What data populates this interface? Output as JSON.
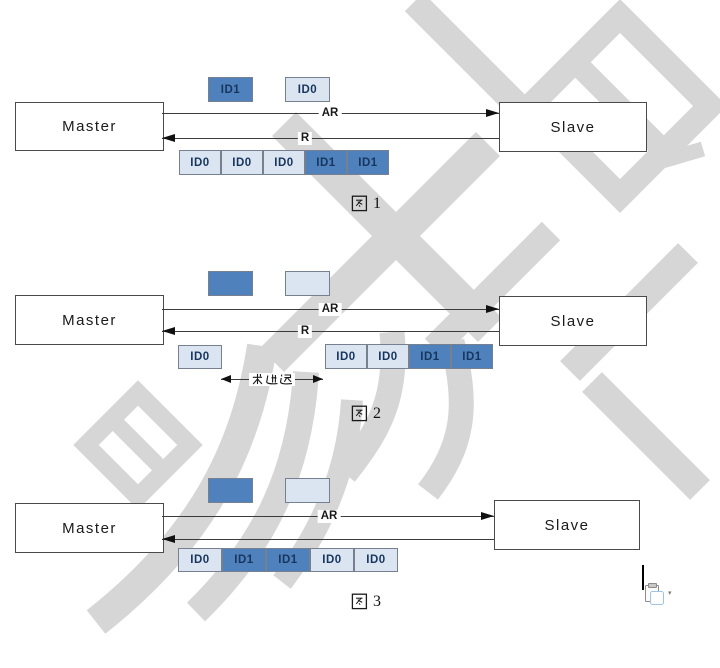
{
  "document": {
    "type": "master-slave transaction timing figures",
    "background": "#ffffff"
  },
  "watermark": {
    "description": "large light-gray CJK character strokes rotated diagonally across page",
    "color": "#d6d6d6",
    "readable": false
  },
  "figures": [
    {
      "caption": "图 1",
      "caption_number": "1",
      "master": "Master",
      "slave": "Slave",
      "ar_label": "AR",
      "r_label": "R",
      "queue": [
        {
          "label": "ID1",
          "variant": "blue"
        },
        {
          "label": "ID0",
          "variant": "light"
        }
      ],
      "row": [
        {
          "label": "ID0",
          "variant": "light"
        },
        {
          "label": "ID0",
          "variant": "light"
        },
        {
          "label": "ID0",
          "variant": "light"
        },
        {
          "label": "ID1",
          "variant": "blue"
        },
        {
          "label": "ID1",
          "variant": "blue"
        }
      ]
    },
    {
      "caption": "图 2",
      "caption_number": "2",
      "master": "Master",
      "slave": "Slave",
      "ar_label": "AR",
      "r_label": "R",
      "delay_label": "长延迟",
      "first_response": [
        {
          "label": "ID0",
          "variant": "light"
        }
      ],
      "row": [
        {
          "label": "ID0",
          "variant": "light"
        },
        {
          "label": "ID0",
          "variant": "light"
        },
        {
          "label": "ID1",
          "variant": "blue"
        },
        {
          "label": "ID1",
          "variant": "blue"
        }
      ]
    },
    {
      "caption": "图 3",
      "caption_number": "3",
      "master": "Master",
      "slave": "Slave",
      "ar_label": "AR",
      "row": [
        {
          "label": "ID0",
          "variant": "light"
        },
        {
          "label": "ID1",
          "variant": "blue"
        },
        {
          "label": "ID1",
          "variant": "blue"
        },
        {
          "label": "ID0",
          "variant": "light"
        },
        {
          "label": "ID0",
          "variant": "light"
        }
      ]
    }
  ],
  "paste_options": {
    "dropdown_glyph": "▾"
  },
  "colors": {
    "id_blue": "#4f81bd",
    "id_light": "#dbe5f1",
    "cell_border": "#76808e",
    "box_border": "#4a4a4a",
    "id_text": "#17365d",
    "arrow": "#111111",
    "watermark": "#d6d6d6"
  }
}
